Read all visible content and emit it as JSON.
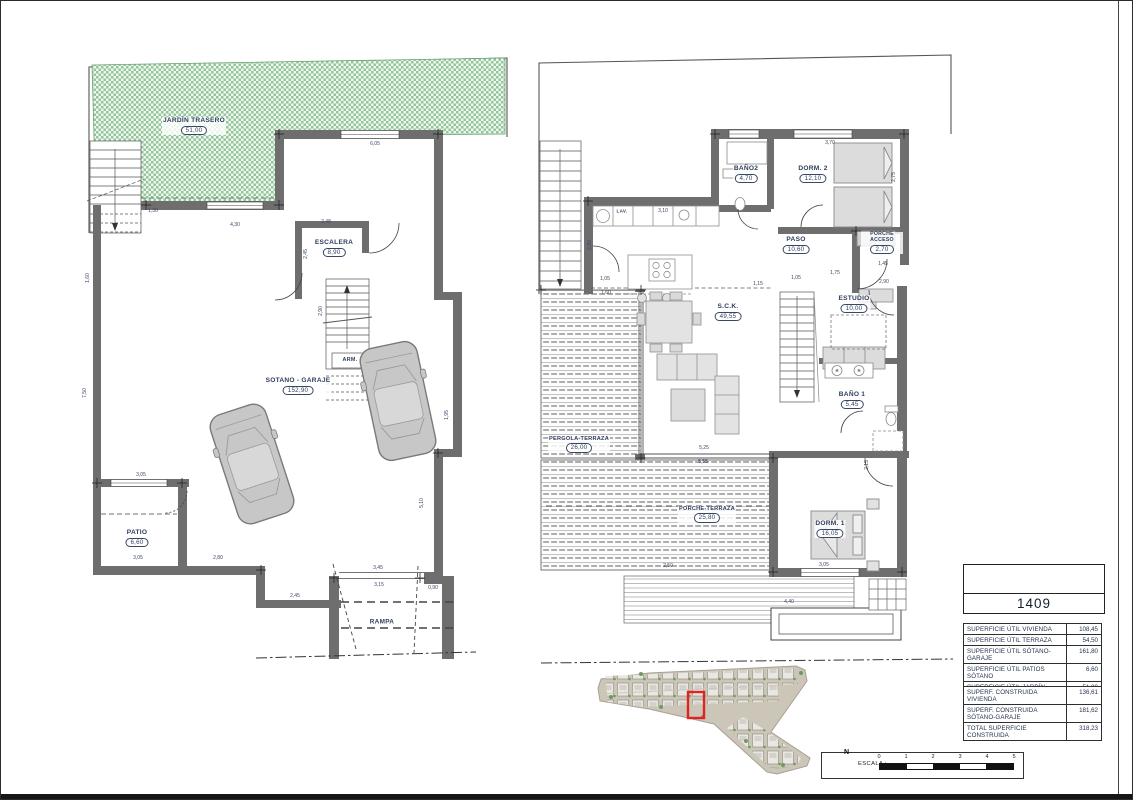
{
  "drawing": {
    "unit_number": "1409",
    "compass_label": "N",
    "scale_label": "ESCALA :",
    "scale_ticks": [
      "0",
      "1",
      "2",
      "3",
      "4",
      "5"
    ]
  },
  "rooms_left": [
    {
      "label": "JARDÍN TRASERO",
      "value": "51,00"
    },
    {
      "label": "ESCALERA",
      "value": "8,90"
    },
    {
      "label": "SOTANO - GARAJE",
      "value": "152,90"
    },
    {
      "label": "PATIO",
      "value": "6,60"
    }
  ],
  "rooms_right": [
    {
      "label": "BAÑO2",
      "value": "4,70"
    },
    {
      "label": "DORM. 2",
      "value": "12,10"
    },
    {
      "label": "PASO",
      "value": "10,60"
    },
    {
      "label": "PORCHE ACCESO",
      "value": "2,70"
    },
    {
      "label": "ESTUDIO",
      "value": "10,00"
    },
    {
      "label": "S.C.K.",
      "value": "49,55"
    },
    {
      "label": "BAÑO 1",
      "value": "5,45"
    },
    {
      "label": "DORM. 1",
      "value": "16,05"
    },
    {
      "label": "PERGOLA-TERRAZA",
      "value": "26,00"
    },
    {
      "label": "PORCHE-TERRAZA",
      "value": "25,80"
    }
  ],
  "annotations": [
    {
      "text": "ARM."
    },
    {
      "text": "RAMPA"
    },
    {
      "text": "LAV."
    }
  ],
  "dims_left": [
    "1,30",
    "4,30",
    "2,48",
    "6,05",
    "1,60",
    "7,50",
    "2,45",
    "2,90",
    "1,95",
    "5,10",
    "3,05",
    "3,05",
    "2,80",
    "2,45",
    "3,45",
    "3,15",
    "0,90"
  ],
  "dims_right": [
    "3,70",
    "2,75",
    "3,10",
    "2,80",
    "1,05",
    "1,60",
    "1,15",
    "1,05",
    "1,75",
    "2,90",
    "1,45",
    "5,25",
    "5,55",
    "2,50",
    "3,05",
    "4,40",
    "2,15"
  ],
  "tables": {
    "util": {
      "rows": [
        {
          "label": "SUPERFICIE ÚTIL VIVIENDA",
          "value": "108,45"
        },
        {
          "label": "SUPERFICIE ÚTIL TERRAZA",
          "value": "54,50"
        },
        {
          "label": "SUPERFICIE ÚTIL SÓTANO-GARAJE",
          "value": "161,80"
        },
        {
          "label": "SUPERFICIE ÚTIL PATIOS SÓTANO",
          "value": "6,60"
        },
        {
          "label": "SUPERFICIE ÚTIL JARDÍN TRASERO",
          "value": "51,00"
        }
      ]
    },
    "construida": {
      "rows": [
        {
          "label": "SUPERF. CONSTRUIDA VIVIENDA",
          "value": "136,61"
        },
        {
          "label": "SUPERF. CONSTRUIDA SÓTANO-GARAJE",
          "value": "181,62"
        },
        {
          "label": "TOTAL SUPERFICIE CONSTRUIDA",
          "value": "318,23"
        }
      ]
    }
  }
}
